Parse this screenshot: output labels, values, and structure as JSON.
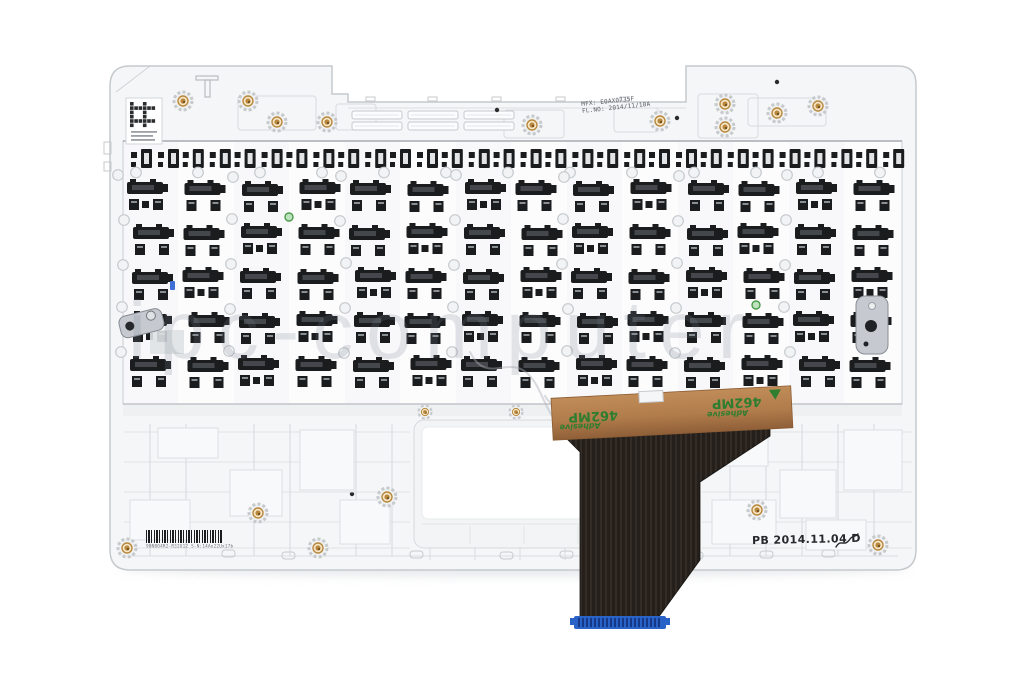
{
  "photo_subject": "laptop-topcase-keyboard-rear-view",
  "watermark": {
    "text": "ipc-computer"
  },
  "stamps": {
    "date_code": "PB 2014.11.04 D",
    "mfx_line1": "MFX: E0AX0735F",
    "mfx_line2": "FL.NO: 2014/11/10A",
    "barcode_caption": "90NB04R2-R32U12   S-N:14An22Ux17b"
  },
  "tape": {
    "label_number": "462MP",
    "label_word": "Adhesive"
  },
  "plate": {
    "clip_rows": 5,
    "clip_cols": 14,
    "top_row_units": 15
  },
  "colors": {
    "background": "#ffffff",
    "plastic": "#f5f6f8",
    "plastic_line": "#c6cacd",
    "rib_line": "#dcdfe2",
    "plate_bg": "#fcfcfd",
    "clip_dark": "#1a1c1e",
    "clip_mid": "#44484c",
    "hole_ring": "#c6cacd",
    "hole_fill": "#f2f3f5",
    "brass": "#b8883e",
    "brass_light": "#f8e7c8",
    "brass_dark": "#6e4d1d",
    "tape_copper": "#b17c4b",
    "tape_copper_dark": "#8f5f38",
    "tape_green": "#2f7d2f",
    "ribbon_dark": "#241f1b",
    "ribbon_light": "#332c26",
    "connector_blue": "#2a63c8",
    "connector_teeth": "#10307a",
    "metal_bracket": "#c6cad0",
    "metal_edge": "#878d93",
    "watermark_gray": "rgba(122,132,144,0.20)",
    "stamp_ink": "#26282c"
  }
}
